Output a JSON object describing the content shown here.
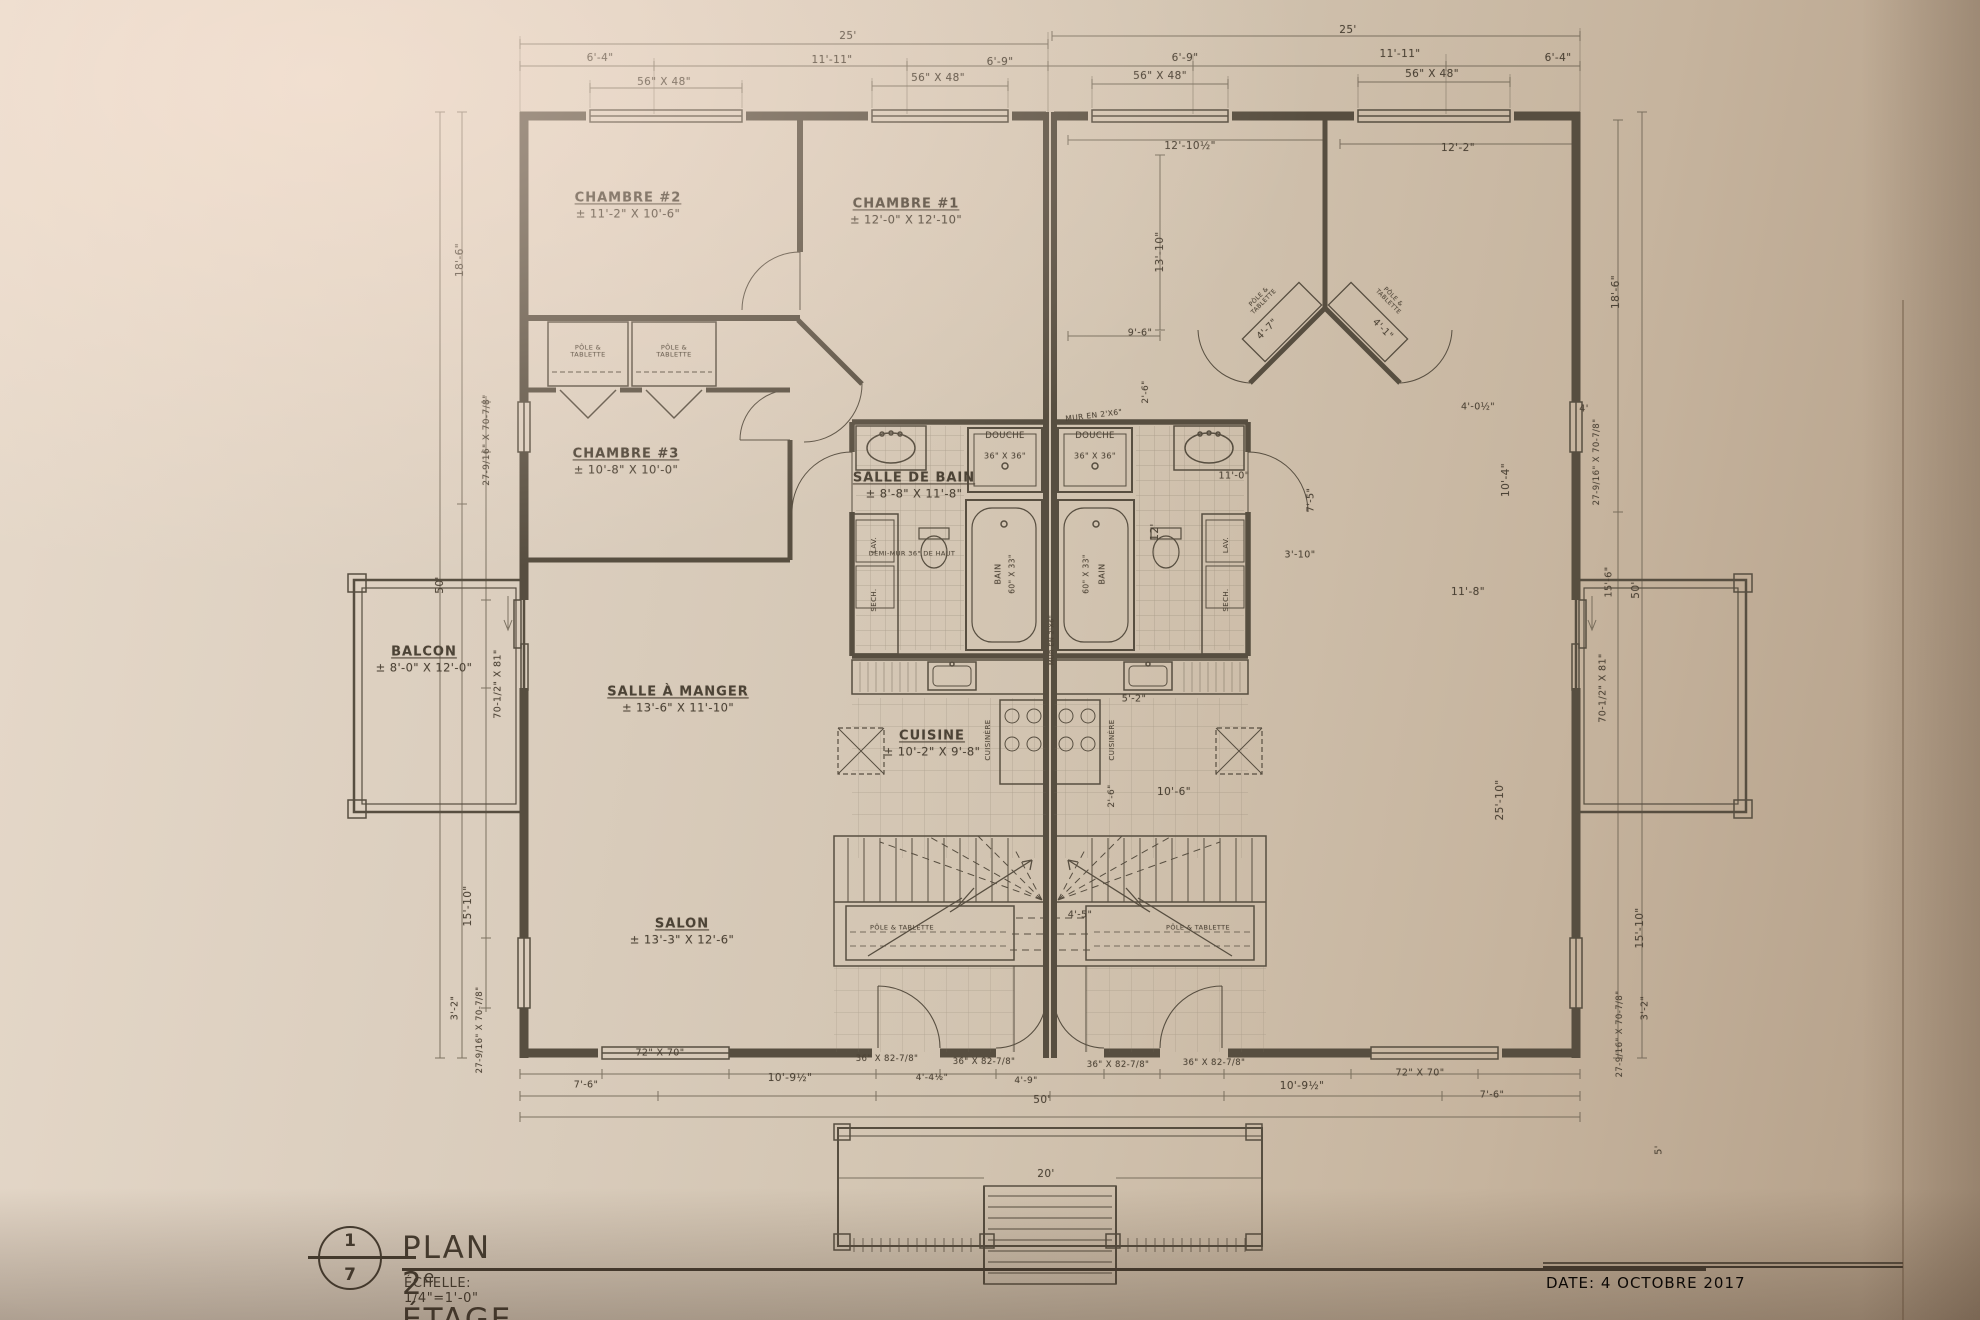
{
  "colors": {
    "paper": "#d5c8b7",
    "ink": "#4c4336",
    "wall": "#574e40",
    "dim_line": "#6b6252"
  },
  "title_block": {
    "sheet_no": "1",
    "sheet_total": "7",
    "title_prefix": "PLAN 2",
    "title_sup": "e",
    "title_suffix": " ÉTAGE",
    "scale": "ÉCHELLE: 1/4\"=1'-0\""
  },
  "date_label": "DATE: 4 OCTOBRE 2017",
  "rooms": [
    {
      "name": "CHAMBRE #2",
      "size": "± 11'-2\" X 10'-6\"",
      "x": 628,
      "y": 206
    },
    {
      "name": "CHAMBRE #1",
      "size": "± 12'-0\" X 12'-10\"",
      "x": 906,
      "y": 212
    },
    {
      "name": "CHAMBRE #3",
      "size": "± 10'-8\" X 10'-0\"",
      "x": 626,
      "y": 462
    },
    {
      "name": "SALLE DE BAIN",
      "size": "± 8'-8\" X 11'-8\"",
      "x": 914,
      "y": 486
    },
    {
      "name": "SALLE À MANGER",
      "size": "± 13'-6\" X 11'-10\"",
      "x": 678,
      "y": 700
    },
    {
      "name": "CUISINE",
      "size": "± 10'-2\" X 9'-8\"",
      "x": 932,
      "y": 744
    },
    {
      "name": "SALON",
      "size": "± 13'-3\" X 12'-6\"",
      "x": 682,
      "y": 932
    },
    {
      "name": "BALCON",
      "size": "± 8'-0\" X 12'-0\"",
      "x": 424,
      "y": 660
    }
  ],
  "fixtures": [
    {
      "text": "DOUCHE",
      "x": 1005,
      "y": 437,
      "size": 8.5
    },
    {
      "text": "36\" X 36\"",
      "x": 1005,
      "y": 456,
      "size": 8
    },
    {
      "text": "DOUCHE",
      "x": 1095,
      "y": 437,
      "size": 8.5
    },
    {
      "text": "36\" X 36\"",
      "x": 1095,
      "y": 456,
      "size": 8
    },
    {
      "text": "BAIN",
      "x": 998,
      "y": 574,
      "rot": -90,
      "size": 8
    },
    {
      "text": "60\" X 33\"",
      "x": 1013,
      "y": 574,
      "rot": -90,
      "size": 7.5
    },
    {
      "text": "BAIN",
      "x": 1102,
      "y": 574,
      "rot": -90,
      "size": 8
    },
    {
      "text": "60\" X 33\"",
      "x": 1087,
      "y": 574,
      "rot": -90,
      "size": 7.5
    },
    {
      "text": "LAV.",
      "x": 874,
      "y": 545,
      "rot": -90,
      "size": 7
    },
    {
      "text": "SECH.",
      "x": 874,
      "y": 600,
      "rot": -90,
      "size": 7
    },
    {
      "text": "LAV.",
      "x": 1226,
      "y": 545,
      "rot": -90,
      "size": 7
    },
    {
      "text": "SECH.",
      "x": 1226,
      "y": 600,
      "rot": -90,
      "size": 7
    },
    {
      "text": "CUISINÈRE",
      "x": 988,
      "y": 740,
      "rot": -90,
      "size": 7
    },
    {
      "text": "CUISINÈRE",
      "x": 1112,
      "y": 740,
      "rot": -90,
      "size": 7
    },
    {
      "text": "PÔLE & TABLETTE",
      "x": 588,
      "y": 352,
      "size": 6.5,
      "w": 58
    },
    {
      "text": "PÔLE & TABLETTE",
      "x": 674,
      "y": 352,
      "size": 6.5,
      "w": 58
    },
    {
      "text": "PÔLE & TABLETTE",
      "x": 902,
      "y": 928,
      "size": 6.5,
      "w": 66
    },
    {
      "text": "PÔLE & TABLETTE",
      "x": 1198,
      "y": 928,
      "size": 6.5,
      "w": 66
    },
    {
      "text": "PÔLE & TABLETTE",
      "x": 1262,
      "y": 300,
      "size": 6,
      "w": 56,
      "rot": -45
    },
    {
      "text": "PÔLE & TABLETTE",
      "x": 1390,
      "y": 300,
      "size": 6,
      "w": 56,
      "rot": 45
    },
    {
      "text": "MUR EN 2'X6\"",
      "x": 1094,
      "y": 416,
      "size": 7.5,
      "rot": -7
    },
    {
      "text": "DEMI-MUR 36\" DE HAUT",
      "x": 912,
      "y": 554,
      "size": 6.5
    },
    {
      "text": "MUR EN 2'X6\"",
      "x": 1052,
      "y": 640,
      "rot": -90,
      "size": 6.5
    }
  ],
  "dimensions": [
    {
      "text": "25'",
      "x": 848,
      "y": 36
    },
    {
      "text": "25'",
      "x": 1348,
      "y": 30
    },
    {
      "text": "6'-4\"",
      "x": 600,
      "y": 58
    },
    {
      "text": "11'-11\"",
      "x": 832,
      "y": 60
    },
    {
      "text": "6'-9\"",
      "x": 1000,
      "y": 62
    },
    {
      "text": "6'-9\"",
      "x": 1185,
      "y": 58
    },
    {
      "text": "11'-11\"",
      "x": 1400,
      "y": 54
    },
    {
      "text": "6'-4\"",
      "x": 1558,
      "y": 58
    },
    {
      "text": "56\" X 48\"",
      "x": 664,
      "y": 82
    },
    {
      "text": "56\" X 48\"",
      "x": 938,
      "y": 78
    },
    {
      "text": "56\" X 48\"",
      "x": 1160,
      "y": 76
    },
    {
      "text": "56\" X 48\"",
      "x": 1432,
      "y": 74
    },
    {
      "text": "12'-10½\"",
      "x": 1190,
      "y": 146
    },
    {
      "text": "12'-2\"",
      "x": 1458,
      "y": 148
    },
    {
      "text": "13'-10\"",
      "x": 1160,
      "y": 252,
      "rot": -90
    },
    {
      "text": "9'-6\"",
      "x": 1140,
      "y": 334,
      "size": 9.5
    },
    {
      "text": "4'-7\"",
      "x": 1268,
      "y": 330,
      "rot": -45,
      "size": 9.5
    },
    {
      "text": "4'-1\"",
      "x": 1382,
      "y": 330,
      "rot": 45,
      "size": 9.5
    },
    {
      "text": "2'-6\"",
      "x": 1146,
      "y": 392,
      "rot": -90,
      "size": 9
    },
    {
      "text": "18'-6\"",
      "x": 460,
      "y": 260,
      "rot": -90
    },
    {
      "text": "27-9/16\" X 70-7/8\"",
      "x": 487,
      "y": 440,
      "rot": -90,
      "size": 9
    },
    {
      "text": "50'",
      "x": 440,
      "y": 585,
      "rot": -90
    },
    {
      "text": "70-1/2\" X 81\"",
      "x": 499,
      "y": 684,
      "rot": -90,
      "size": 9.5
    },
    {
      "text": "15'-10\"",
      "x": 468,
      "y": 906,
      "rot": -90
    },
    {
      "text": "3'-2\"",
      "x": 456,
      "y": 1008,
      "rot": -90,
      "size": 9.5
    },
    {
      "text": "27-9/16\" X 70-7/8\"",
      "x": 481,
      "y": 1030,
      "rot": -90,
      "size": 8.5
    },
    {
      "text": "12'",
      "x": 1155,
      "y": 532,
      "rot": -90
    },
    {
      "text": "11'-0\"",
      "x": 1234,
      "y": 477,
      "size": 9.5
    },
    {
      "text": "7'-5\"",
      "x": 1312,
      "y": 500,
      "rot": -90,
      "size": 9.5
    },
    {
      "text": "10'-4\"",
      "x": 1506,
      "y": 480,
      "rot": -90
    },
    {
      "text": "3'-10\"",
      "x": 1300,
      "y": 556,
      "size": 9.5
    },
    {
      "text": "11'-8\"",
      "x": 1468,
      "y": 592
    },
    {
      "text": "4'-0½\"",
      "x": 1478,
      "y": 408,
      "size": 9.5
    },
    {
      "text": "4'",
      "x": 1584,
      "y": 410,
      "size": 9.5
    },
    {
      "text": "5'-2\"",
      "x": 1134,
      "y": 700,
      "size": 9.5
    },
    {
      "text": "10'-6\"",
      "x": 1174,
      "y": 792
    },
    {
      "text": "25'-10\"",
      "x": 1500,
      "y": 800,
      "rot": -90
    },
    {
      "text": "2'-6\"",
      "x": 1112,
      "y": 796,
      "rot": -90,
      "size": 9
    },
    {
      "text": "4'-5\"",
      "x": 1080,
      "y": 916,
      "size": 9.5
    },
    {
      "text": "18'-6\"",
      "x": 1616,
      "y": 292,
      "rot": -90
    },
    {
      "text": "27-9/16\" X 70-7/8\"",
      "x": 1598,
      "y": 462,
      "rot": -90,
      "size": 8.5
    },
    {
      "text": "15'-6\"",
      "x": 1610,
      "y": 582,
      "rot": -90,
      "size": 9.5
    },
    {
      "text": "50'",
      "x": 1636,
      "y": 590,
      "rot": -90
    },
    {
      "text": "70-1/2\" X 81\"",
      "x": 1604,
      "y": 688,
      "rot": -90,
      "size": 9.5
    },
    {
      "text": "15'-10\"",
      "x": 1640,
      "y": 928,
      "rot": -90
    },
    {
      "text": "3'-2\"",
      "x": 1646,
      "y": 1008,
      "rot": -90,
      "size": 9.5
    },
    {
      "text": "27-9/16\" X 70-7/8\"",
      "x": 1621,
      "y": 1034,
      "rot": -90,
      "size": 8.5
    },
    {
      "text": "5'",
      "x": 1660,
      "y": 1150,
      "rot": -90,
      "size": 9.5
    },
    {
      "text": "72\" X 70\"",
      "x": 660,
      "y": 1054,
      "size": 9.5
    },
    {
      "text": "7'-6\"",
      "x": 586,
      "y": 1086,
      "size": 9.5
    },
    {
      "text": "10'-9½\"",
      "x": 790,
      "y": 1078
    },
    {
      "text": "36\" X 82-7/8\"",
      "x": 887,
      "y": 1060,
      "size": 8.5
    },
    {
      "text": "36\" X 82-7/8\"",
      "x": 984,
      "y": 1063,
      "size": 8.5
    },
    {
      "text": "36\" X 82-7/8\"",
      "x": 1118,
      "y": 1066,
      "size": 8.5
    },
    {
      "text": "36\" X 82-7/8\"",
      "x": 1214,
      "y": 1064,
      "size": 8.5
    },
    {
      "text": "4'-4½\"",
      "x": 932,
      "y": 1078,
      "size": 9
    },
    {
      "text": "4'-9\"",
      "x": 1026,
      "y": 1081,
      "size": 9
    },
    {
      "text": "50'",
      "x": 1042,
      "y": 1100
    },
    {
      "text": "10'-9½\"",
      "x": 1302,
      "y": 1086
    },
    {
      "text": "72\" X 70\"",
      "x": 1420,
      "y": 1074,
      "size": 9.5
    },
    {
      "text": "7'-6\"",
      "x": 1492,
      "y": 1096,
      "size": 9.5
    },
    {
      "text": "20'",
      "x": 1046,
      "y": 1174
    }
  ]
}
